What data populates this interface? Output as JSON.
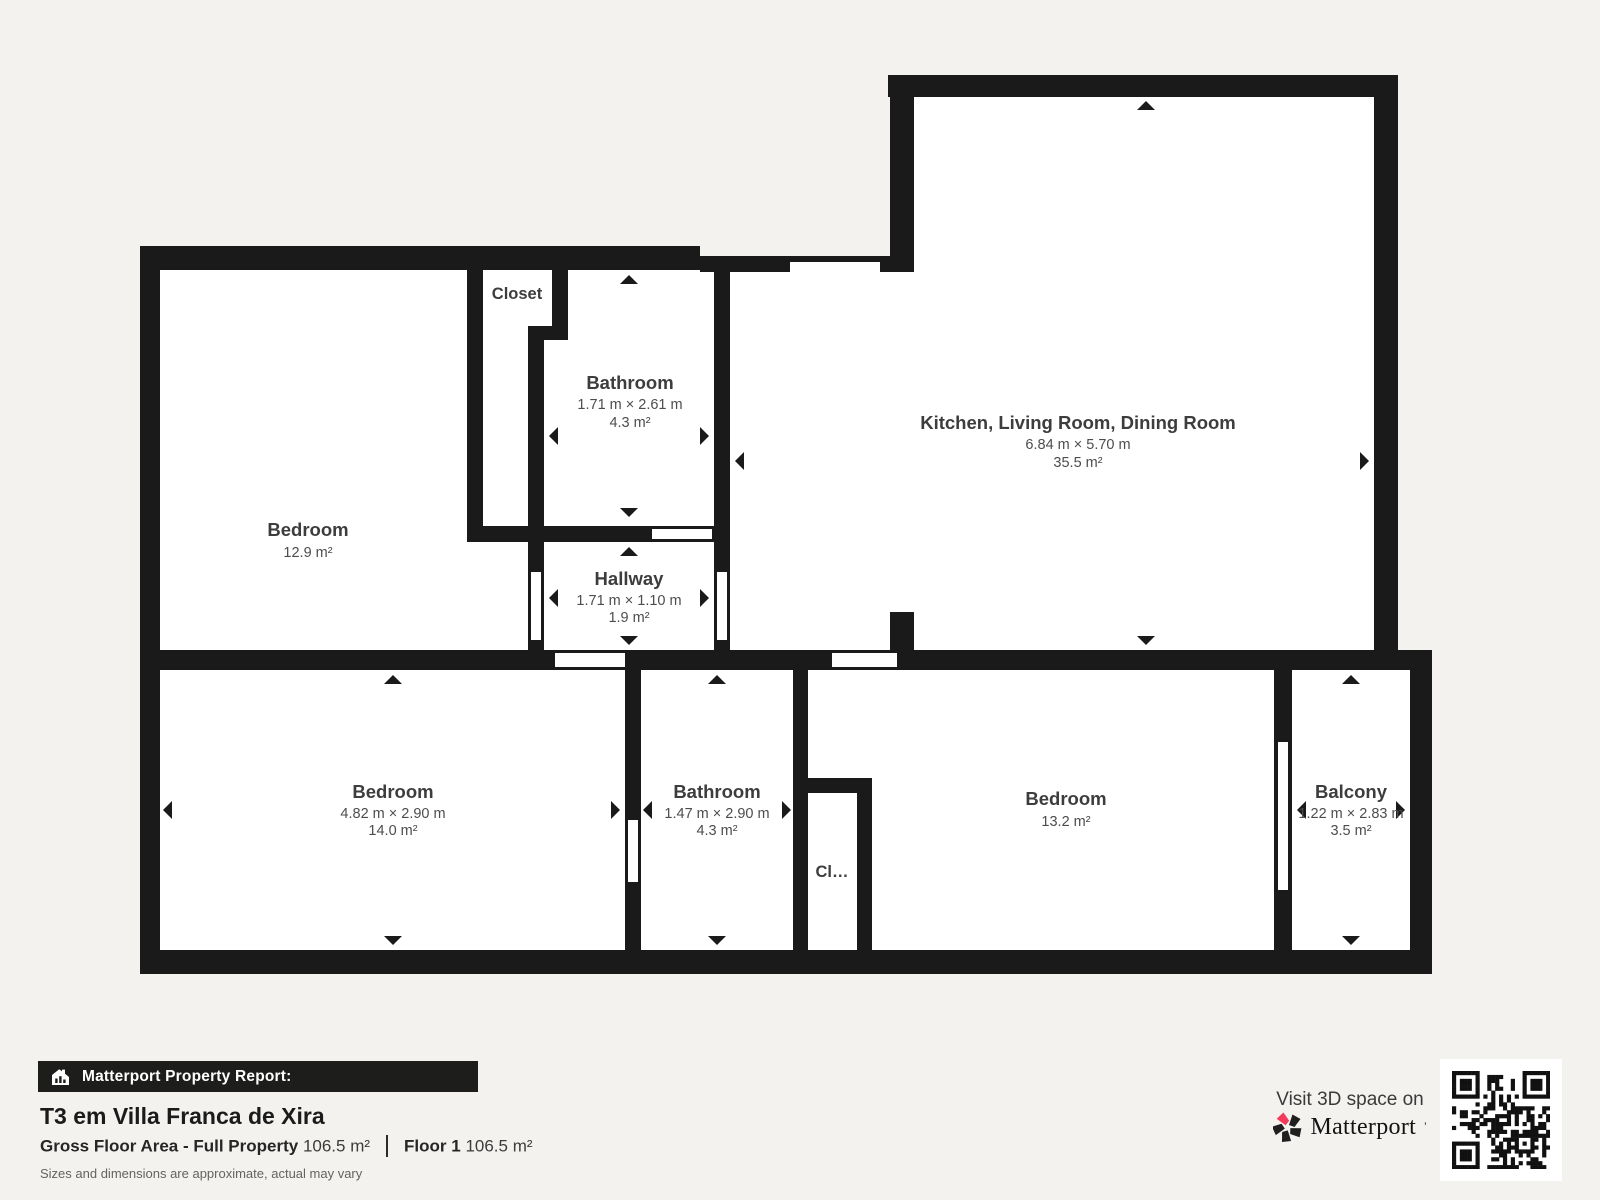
{
  "colors": {
    "background": "#f3f2ef",
    "wall": "#1a1a1a",
    "room_fill": "#ffffff",
    "footer_bar": "#1d1d1b",
    "brand_red": "#f43a5a",
    "room_name_text": "#3d3d3d",
    "room_sub_text": "#4d4d4d",
    "muted_text": "#636363"
  },
  "rooms": {
    "bedroom1": {
      "name": "Bedroom",
      "area": "12.9 m²"
    },
    "closet1": {
      "name": "Closet"
    },
    "bathroom1": {
      "name": "Bathroom",
      "dims": "1.71 m × 2.61 m",
      "area": "4.3 m²"
    },
    "hallway": {
      "name": "Hallway",
      "dims": "1.71 m × 1.10 m",
      "area": "1.9 m²"
    },
    "kitchen": {
      "name": "Kitchen, Living Room, Dining Room",
      "dims": "6.84 m × 5.70 m",
      "area": "35.5 m²"
    },
    "bedroom2": {
      "name": "Bedroom",
      "dims": "4.82 m × 2.90 m",
      "area": "14.0 m²"
    },
    "bathroom2": {
      "name": "Bathroom",
      "dims": "1.47 m × 2.90 m",
      "area": "4.3 m²"
    },
    "closet2": {
      "name": "Cl…"
    },
    "bedroom3": {
      "name": "Bedroom",
      "area": "13.2 m²"
    },
    "balcony": {
      "name": "Balcony",
      "dims": "1.22 m × 2.83 m",
      "area": "3.5 m²"
    }
  },
  "footer": {
    "report_label": "Matterport Property Report:",
    "property_title": "T3 em Villa Franca de Xira",
    "gross_label": "Gross Floor Area - Full Property",
    "gross_value": "106.5 m²",
    "floor_label": "Floor 1",
    "floor_value": "106.5 m²",
    "disclaimer": "Sizes and dimensions are approximate, actual may vary"
  },
  "cta": {
    "visit_text": "Visit 3D space on",
    "brand": "Matterport",
    "brand_mark": "’"
  }
}
